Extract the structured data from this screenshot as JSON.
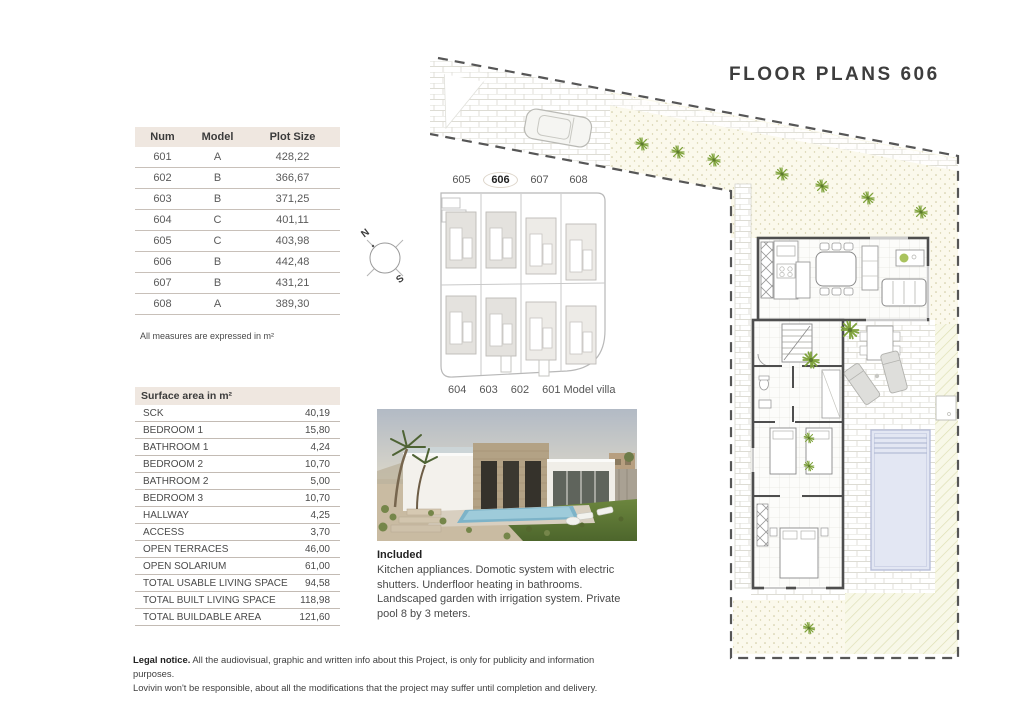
{
  "title": "FLOOR PLANS 606",
  "plot_table": {
    "headers": [
      "Num",
      "Model",
      "Plot Size"
    ],
    "rows": [
      [
        "601",
        "A",
        "428,22"
      ],
      [
        "602",
        "B",
        "366,67"
      ],
      [
        "603",
        "B",
        "371,25"
      ],
      [
        "604",
        "C",
        "401,11"
      ],
      [
        "605",
        "C",
        "403,98"
      ],
      [
        "606",
        "B",
        "442,48"
      ],
      [
        "607",
        "B",
        "431,21"
      ],
      [
        "608",
        "A",
        "389,30"
      ]
    ],
    "note": "All measures are expressed in m²"
  },
  "surface_table": {
    "header": "Surface area in m²",
    "rows": [
      {
        "label": "SCK",
        "value": "40,19"
      },
      {
        "label": "BEDROOM 1",
        "value": "15,80"
      },
      {
        "label": "BATHROOM 1",
        "value": "4,24"
      },
      {
        "label": "BEDROOM 2",
        "value": "10,70"
      },
      {
        "label": "BATHROOM 2",
        "value": "5,00"
      },
      {
        "label": "BEDROOM 3",
        "value": "10,70"
      },
      {
        "label": "HALLWAY",
        "value": "4,25"
      },
      {
        "label": "ACCESS",
        "value": "3,70"
      },
      {
        "label": "OPEN TERRACES",
        "value": "46,00"
      },
      {
        "label": "OPEN SOLARIUM",
        "value": "61,00"
      },
      {
        "label": "TOTAL USABLE LIVING SPACE",
        "value": "94,58"
      },
      {
        "label": "TOTAL BUILT LIVING SPACE",
        "value": "118,98"
      },
      {
        "label": "TOTAL BUILDABLE AREA",
        "value": "121,60"
      }
    ]
  },
  "site_plan": {
    "top_labels": [
      "605",
      "606",
      "607",
      "608"
    ],
    "highlighted": "606",
    "bottom_labels": [
      "604",
      "603",
      "602",
      "601 Model villa"
    ],
    "compass": {
      "north": "N",
      "south": "S"
    }
  },
  "included": {
    "heading": "Included",
    "text": "Kitchen appliances. Domotic system with electric shutters. Underfloor heating in bathrooms. Landscaped garden with irrigation system. Private pool 8 by 3 meters."
  },
  "legal": {
    "lead": "Legal notice.",
    "line1": " All the audiovisual, graphic and written info about this Project, is only for publicity and information purposes.",
    "line2": "Lovivin won't be responsible, about all the modifications that the project may suffer until completion and delivery."
  },
  "colors": {
    "header_beige": "#efe7e0",
    "pool_blue": "#e3e7f3",
    "plant_green": "#8fae4c",
    "wall_grey": "#4e4e4e"
  }
}
